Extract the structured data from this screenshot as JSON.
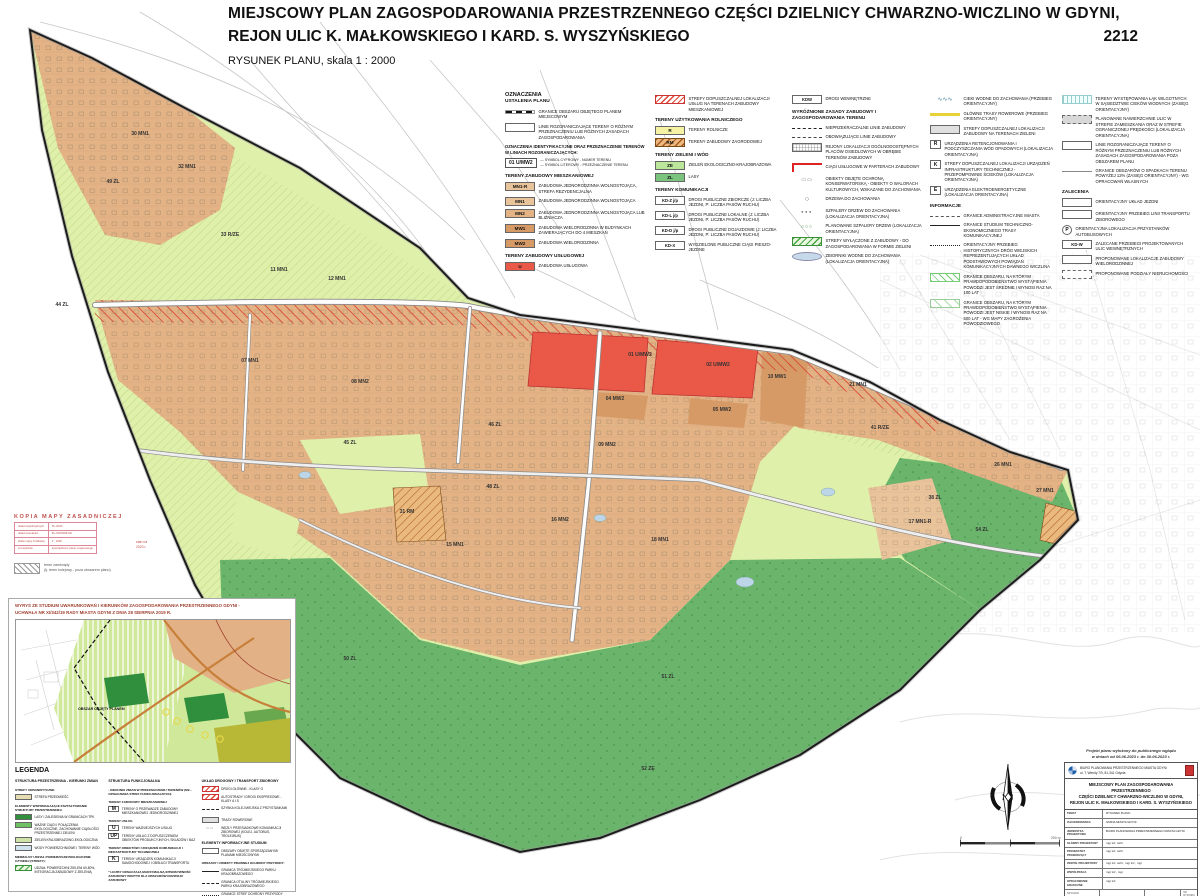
{
  "header": {
    "title_line1": "MIEJSCOWY PLAN ZAGOSPODAROWANIA PRZESTRZENNEGO CZĘŚCI DZIELNICY CHWARZNO-WICZLINO W GDYNI,",
    "title_line2": "REJON ULIC K. MAŁKOWSKIEGO I KARD. S. WYSZYŃSKIEGO",
    "plan_number": "2212",
    "subtitle": "RYSUNEK PLANU, skala 1 : 2000"
  },
  "colors": {
    "residential_tan": "#e3b285",
    "residential_dark_tan": "#d69a66",
    "services_red": "#ea5948",
    "agricultural_yellow": "#f5f2a4",
    "green_eco": "#dff0aa",
    "green_forest": "#6ab46c",
    "green_pale_band": "#bce79a",
    "stamp_red": "#c0504d",
    "boundary": "#1c1c1c"
  },
  "plan_legend": {
    "title": "OZNACZENIA",
    "subtitle": "USTALENIA PLANU",
    "columns": [
      [
        {
          "k": "title",
          "t": "OZNACZENIA"
        },
        {
          "k": "sub",
          "t": "USTALENIA PLANU"
        },
        {
          "k": "boundary",
          "t": "GRANICE OBSZARU OBJĘTEGO PLANEM MIEJSCOWYM"
        },
        {
          "k": "rozgran",
          "t": "LINIE ROZGRANICZAJĄCE TERENY O RÓŻNYM PRZEZNACZENIU LUB RÓŻNYCH ZASADACH ZAGOSPODAROWANIA"
        },
        {
          "k": "note",
          "t": "OZNACZENIA IDENTYFIKACYJNE ORAZ PRZEZNACZENIE TERENÓW W LINIACH ROZGRANICZAJĄCYCH:"
        },
        {
          "k": "example",
          "t": "01 U/MW2",
          "a": "SYMBOL CYFROWY - NUMER TERENU",
          "b": "SYMBOL LITEROWY - PRZEZNACZENIE TERENU"
        },
        {
          "k": "h",
          "t": "TERENY ZABUDOWY MIESZKANIOWEJ"
        },
        {
          "k": "sw",
          "c": "#e9c49b",
          "l": "MN1-R",
          "t": "ZABUDOWA JEDNORODZINNA WOLNOSTOJĄCA, STREFA REZYDENCJALNA"
        },
        {
          "k": "sw",
          "c": "#e9c49b",
          "l": "MN1",
          "t": "ZABUDOWA JEDNORODZINNA WOLNOSTOJĄCA"
        },
        {
          "k": "sw",
          "c": "#e3b285",
          "l": "MN2",
          "t": "ZABUDOWA JEDNORODZINNA WOLNOSTOJĄCA LUB BLIŹNIACZA"
        },
        {
          "k": "sw",
          "c": "#d69a66",
          "l": "MW1",
          "t": "ZABUDOWA WIELORODZINNA W BUDYNKACH ZAWIERAJĄCYCH DO 4 MIESZKAŃ"
        },
        {
          "k": "sw",
          "c": "#d69a66",
          "l": "MW2",
          "t": "ZABUDOWA WIELORODZINNA"
        },
        {
          "k": "h",
          "t": "TERENY ZABUDOWY USŁUGOWEJ"
        },
        {
          "k": "sw",
          "c": "#ea5948",
          "l": "U",
          "t": "ZABUDOWA USŁUGOWA"
        }
      ],
      [
        {
          "k": "hatchred",
          "t": "STREFY DOPUSZCZALNEJ LOKALIZACJI USŁUG NA TERENACH ZABUDOWY MIESZKANIOWEJ"
        },
        {
          "k": "h",
          "t": "TERENY UŻYTKOWANIA ROLNICZEGO"
        },
        {
          "k": "sw",
          "c": "#f5f2a4",
          "l": "R",
          "t": "TERENY ROLNICZE"
        },
        {
          "k": "hatchrm",
          "l": "RM",
          "t": "TERENY ZABUDOWY ZAGRODOWEJ"
        },
        {
          "k": "h",
          "t": "TERENY ZIELENI I WÓD"
        },
        {
          "k": "sw",
          "c": "#bce79a",
          "l": "ZE",
          "t": "ZIELEŃ EKOLOGICZNO-KRAJOBRAZOWA"
        },
        {
          "k": "sw",
          "c": "#7bc47e",
          "l": "ZL",
          "t": "LASY"
        },
        {
          "k": "h",
          "t": "TERENY KOMUNIKACJI"
        },
        {
          "k": "kd",
          "l": "KD-Z j/p",
          "t": "DROGI PUBLICZNE ZBIORCZE (J: LICZBA JEZDNI, P: LICZBA PASÓW RUCHU)"
        },
        {
          "k": "kd",
          "l": "KD-L j/p",
          "t": "DROGI PUBLICZNE LOKALNE (J: LICZBA JEZDNI, P: LICZBA PASÓW RUCHU)"
        },
        {
          "k": "kd",
          "l": "KD-D j/p",
          "t": "DROGI PUBLICZNE DOJAZDOWE (J: LICZBA JEZDNI, P: LICZBA PASÓW RUCHU)"
        },
        {
          "k": "kd",
          "l": "KD-X",
          "t": "WYDZIELONE PUBLICZNE CIĄGI PIESZO-JEZDNE"
        }
      ],
      [
        {
          "k": "kd",
          "l": "KDW",
          "t": "DROGI WEWNĘTRZNE"
        },
        {
          "k": "h",
          "t": "WYRÓŻNIONE ZASADY ZABUDOWY I ZAGOSPODAROWANIA TERENU"
        },
        {
          "k": "ldash",
          "t": "NIEPRZEKRACZALNE LINIE ZABUDOWY"
        },
        {
          "k": "ldashdot",
          "t": "OBOWIĄZUJĄCE LINIE ZABUDOWY"
        },
        {
          "k": "grid",
          "t": "REJONY LOKALIZACJI OGÓLNODOSTĘPNYCH PLACÓW OSIEDLOWYCH W OBRĘBIE TERENÓW ZABUDOWY"
        },
        {
          "k": "corner",
          "t": "CIĄGI USŁUGOWE W PARTERACH ZABUDOWY"
        },
        {
          "k": "monu",
          "t": "OBIEKTY OBJĘTE OCHRONĄ KONSERWATORSKĄ - OBIEKTY O WALORACH KULTUROWYCH, WSKAZANE DO ZACHOWANIA"
        },
        {
          "k": "tree",
          "t": "DRZEWA DO ZACHOWANIA"
        },
        {
          "k": "dots",
          "t": "SZPALERY DRZEW DO ZACHOWANIA (LOKALIZACJA ORIENTACYJNA)"
        },
        {
          "k": "gdots",
          "t": "PLANOWANE SZPALERY DRZEW (LOKALIZACJA ORIENTACYJNA)"
        },
        {
          "k": "ghatch",
          "t": "STREFY WYŁĄCZONE Z ZABUDOWY - DO ZAGOSPODAROWANIA W FORMIE ZIELENI"
        },
        {
          "k": "pond",
          "t": "ZBIORNIKI WODNE DO ZACHOWANIA (LOKALIZACJA ORIENTACYJNA)"
        }
      ],
      [
        {
          "k": "wave",
          "t": "CIEKI WODNE DO ZACHOWANIA (PRZEBIEG ORIENTACYJNY)"
        },
        {
          "k": "cycle",
          "t": "GŁÓWNE TRASY ROWEROWE (PRZEBIEG ORIENTACYJNY)"
        },
        {
          "k": "graybox",
          "t": "STREFY DOPUSZCZALNEJ LOKALIZACJI ZABUDOWY NA TERENACH ZIELENI"
        },
        {
          "k": "lbox",
          "l": "R",
          "t": "URZĄDZENIA RETENCJONOWANIA I PODCZYSZCZANIA WÓD OPADOWYCH (LOKALIZACJA ORIENTACYJNA)"
        },
        {
          "k": "lbox",
          "l": "K",
          "t": "STREFY DOPUSZCZALNEJ LOKALIZACJI URZĄDZEŃ INFRASTRUKTURY TECHNICZNEJ - PRZEPOMPOWNIE ŚCIEKÓW (LOKALIZACJA ORIENTACYJNA)"
        },
        {
          "k": "lbox",
          "l": "E",
          "t": "URZĄDZENIA ELEKTROENERGETYCZNE (LOKALIZACJA ORIENTACYJNA)"
        },
        {
          "k": "h",
          "t": "INFORMACJE"
        },
        {
          "k": "ladmin",
          "t": "GRANICE ADMINISTRACYJNE MIASTA"
        },
        {
          "k": "lsolid",
          "t": "GRANICE STUDIUM TECHNICZNO-EKONOMICZNEGO TRASY KOMUNIKACYJNEJ"
        },
        {
          "k": "ldot",
          "t": "ORIENTACYJNY PRZEBIEG HISTORYCZNYCH DRÓG WIEJSKICH REPREZENTUJĄCYCH UKŁAD PODSTAWOWYCH POWIĄZAŃ KOMUNIKACYJNYCH DAWNEGO WICZLINA"
        },
        {
          "k": "flood",
          "t": "GRANICE OBSZARU, NA KTÓRYM PRAWDOPODOBIEŃSTWO WYSTĄPIENIA POWODZI JEST ŚREDNIE I WYNOSI RAZ NA 100 LAT"
        },
        {
          "k": "flood2",
          "t": "GRANICE OBSZARU, NA KTÓRYM PRAWDOPODOBIEŃSTWO WYSTĄPIENIA POWODZI JEST NISKIE I WYNOSI RAZ NA 500 LAT - WG MAPY ZAGROŻENIA POWODZIOWEGO"
        }
      ],
      [
        {
          "k": "meadow",
          "t": "TERENY WYSTĘPOWANIA ŁĄK WILGOTNYCH W SĄSIEDZTWIE CIEKÓW WODNYCH (ZASIĘG ORIENTACYJNY)"
        },
        {
          "k": "graybox2",
          "t": "PLANOWANE NAWIERZCHNIE ULIC W STREFIE ZAMIESZKANIA ORAZ W STREFIE OGRANICZONEJ PRĘDKOŚCI (LOKALIZACJA ORIENTACYJNA)"
        },
        {
          "k": "rozgran",
          "t": "LINIE ROZGRANICZAJĄCE TERENY O RÓŻNYM PRZEZNACZENIU LUB RÓŻNYCH ZASADACH ZAGOSPODAROWANIA POZA OBSZAREM PLANU"
        },
        {
          "k": "lthin",
          "t": "GRANICE OBSZARÓW O SPADKACH TERENU POWYŻEJ 12% (ZASIĘG ORIENTACYJNY) - WG OPRACOWAŃ WŁASNYCH"
        },
        {
          "k": "h",
          "t": "ZALECENIA"
        },
        {
          "k": "rozgran",
          "t": "ORIENTACYJNY UKŁAD JEZDNI"
        },
        {
          "k": "rozgran",
          "t": "ORIENTACYJNY PRZEBIEG LINII TRANSPORTU ZBIOROWEGO"
        },
        {
          "k": "pcirc",
          "l": "P",
          "t": "ORIENTACYJNA LOKALIZACJA PRZYSTANKÓW AUTOBUSOWYCH"
        },
        {
          "k": "kd",
          "l": "KD-W",
          "t": "ZALECANE PRZEBIEGI PROJEKTOWANYCH ULIC WEWNĘTRZNYCH"
        },
        {
          "k": "boxw",
          "t": "PROPONOWANE LOKALIZACJE ZABUDOWY WIELORODZINNEJ"
        },
        {
          "k": "boxdash",
          "t": "PROPONOWANE PODZIAŁY NIERUCHOMOŚCI"
        }
      ]
    ]
  },
  "map": {
    "zones": [
      [
        140,
        135,
        "30 MN1"
      ],
      [
        113,
        183,
        "49 ZL"
      ],
      [
        187,
        168,
        "32 MN1"
      ],
      [
        62,
        306,
        "44 ZL"
      ],
      [
        230,
        236,
        "33 R/ZE"
      ],
      [
        279,
        271,
        "11 MN1"
      ],
      [
        337,
        280,
        "12 MN1"
      ],
      [
        250,
        362,
        "07 MN1"
      ],
      [
        360,
        383,
        "08 MN2"
      ],
      [
        640,
        356,
        "01 U/MW2"
      ],
      [
        718,
        366,
        "02 U/MW2"
      ],
      [
        615,
        400,
        "04 MW2"
      ],
      [
        722,
        411,
        "05 MW2"
      ],
      [
        607,
        446,
        "09 MN2"
      ],
      [
        777,
        378,
        "10 MW1"
      ],
      [
        495,
        426,
        "46 ZL"
      ],
      [
        493,
        488,
        "48 ZL"
      ],
      [
        350,
        444,
        "45 ZL"
      ],
      [
        407,
        513,
        "31 RM"
      ],
      [
        455,
        546,
        "15 MN1"
      ],
      [
        560,
        521,
        "16 MN2"
      ],
      [
        660,
        541,
        "18 MN1"
      ],
      [
        880,
        429,
        "41 R/ZE"
      ],
      [
        858,
        386,
        "21 MN1"
      ],
      [
        935,
        499,
        "38 ZL"
      ],
      [
        1003,
        466,
        "26 MN1"
      ],
      [
        1045,
        492,
        "27 MN1"
      ],
      [
        920,
        523,
        "17 MN1-R"
      ],
      [
        982,
        531,
        "54 ZL"
      ],
      [
        668,
        678,
        "51 ZL"
      ],
      [
        648,
        770,
        "52 ZE"
      ],
      [
        350,
        660,
        "50 ZL"
      ]
    ],
    "scalebar_left": "0",
    "scalebar_right": "200 m"
  },
  "stamp": {
    "title": "KOPIA MAPY ZASADNICZEJ",
    "rows": [
      [
        "układ współrzędnych",
        "PL-2000"
      ],
      [
        "układ wysokości",
        "PL-KRON86-NH"
      ],
      [
        "skala mapy źródłowej",
        "1 : 1000"
      ],
      [
        "cel wydania",
        "sporządzenie planu miejscowego"
      ]
    ],
    "note_line1": "stan na",
    "note_line2": "2023 r.",
    "closed_line1": "teren zamknięty",
    "closed_line2": "(tj. teren kolejowy - poza obszarem planu)"
  },
  "inset": {
    "title_line1": "WYRYS ZE STUDIUM UWARUNKOWAŃ I KIERUNKÓW ZAGOSPODAROWANIA PRZESTRZENNEGO GDYNI -",
    "title_line2": "UCHWAŁA NR XI/342/19 RADY MIASTA GDYNI Z DNIA 28 SIERPNIA 2019 R.",
    "area_label": "OBSZAR OBJĘTY PLANEM",
    "legend_title": "LEGENDA",
    "columns": [
      [
        {
          "k": "h",
          "t": "STRUKTURA PRZESTRZENNA - KIERUNKI ZMIAN"
        },
        {
          "k": "note",
          "t": "STREFY URBANISTYCZNE"
        },
        {
          "k": "sw",
          "c": "#e6dcb2",
          "t": "strefa przedmieść"
        },
        {
          "k": "note",
          "t": "ELEMENTY WSPOMAGAJĄCE KSZTAŁTOWANIE STRUKTURY PRZESTRZENNEJ:"
        },
        {
          "k": "sw",
          "c": "#2f8f3c",
          "t": "lasy i zalesienia w granicach TPK"
        },
        {
          "k": "sw",
          "c": "#6fbf63",
          "t": "ważne ciągi i połączenia ekologiczne, zachowanie ciągłości przestrzennej zieleni"
        },
        {
          "k": "sw",
          "c": "#cfe3a8",
          "t": "zieleń krajobrazowo-ekologiczna"
        },
        {
          "k": "sw",
          "c": "#cfe2ee",
          "t": "wody powierzchniowe i tereny wód"
        },
        {
          "k": "note",
          "t": "MINIMALNY UDZIAŁ POWIERZCHNI BIOLOGICZNIE CZYNNEJ (STREFY):"
        },
        {
          "k": "ghatch",
          "t": "udział powierzchni zieleni 60-80%, integracja zabudowy z zielenią"
        }
      ],
      [
        {
          "k": "h",
          "t": "STRUKTURA FUNKCJONALNA"
        },
        {
          "k": "note",
          "t": "- KIERUNKI ZMIAN W PRZEZNACZENIU TERENÓW (M2... OZNACZENIA STREF FUNKCJONALNYCH)"
        },
        {
          "k": "note",
          "t": "TERENY ZABUDOWY MIESZKANIOWEJ"
        },
        {
          "k": "lbox",
          "l": "M",
          "t": "tereny o przewadze zabudowy mieszkaniowej jednorodzinnej"
        },
        {
          "k": "note",
          "t": "TERENY USŁUG"
        },
        {
          "k": "lbox",
          "l": "U",
          "t": "tereny ważniejszych usług"
        },
        {
          "k": "lbox",
          "l": "UP",
          "t": "tereny usług z dopuszczeniem obiektów produkcyjnych, składów i baz"
        },
        {
          "k": "note",
          "t": "TERENY OBIEKTÓW I URZĄDZEŃ KOMUNIKACJI I INFRASTRUKTURY TECHNICZNEJ"
        },
        {
          "k": "lbox",
          "l": "K",
          "t": "tereny urządzeń komunikacji samochodowej i obsługi transportu"
        },
        {
          "k": "note",
          "t": "* liczby oznaczają maksymalną intensywność zabudowy brutto dla obszarów rozwoju zabudowy"
        }
      ],
      [
        {
          "k": "h",
          "t": "UKŁAD DROGOWY I TRANSPORT ZBIOROWY"
        },
        {
          "k": "hatchred",
          "t": "drogi główne - klasy G"
        },
        {
          "k": "hatchred",
          "t": "autostrady i drogi ekspresowe - klasy A i S"
        },
        {
          "k": "ldash",
          "t": "szybka kolej miejska z przystankami"
        },
        {
          "k": "graybox",
          "t": "trasy rowerowe"
        },
        {
          "k": "monu",
          "t": "węzły przesiadkowe komunikacji zbiorowej (kolej, autobus, trolejbus)"
        },
        {
          "k": "h",
          "t": "ELEMENTY INFORMACYJNE STUDIUM"
        },
        {
          "k": "boxw",
          "t": "obszary objęte sporządzanymi planami miejscowymi"
        },
        {
          "k": "note",
          "t": "OBSZARY I OBIEKTY PRAWNEJ OCHRONY PRZYRODY:"
        },
        {
          "k": "lsolid",
          "t": "granica Trójmiejskiego Parku Krajobrazowego"
        },
        {
          "k": "ldash",
          "t": "granica otuliny Trójmiejskiego Parku Krajobrazowego"
        },
        {
          "k": "ldot",
          "t": "granice stref ochrony przyrody"
        }
      ]
    ]
  },
  "titleblock": {
    "notice_line1": "Projekt planu wyłożony do publicznego wglądu",
    "notice_line2": "w dniach od 06.06.2023 r. do 30.06.2023 r.",
    "office_line1": "BIURO PLANOWANIA PRZESTRZENNEGO MIASTA GDYNI",
    "office_line2": "ul. T. Wendy 7/9, 81-341 Gdynia",
    "title_l1": "MIEJSCOWY PLAN ZAGOSPODAROWANIA PRZESTRZENNEGO",
    "title_l2": "CZĘŚCI DZIELNICY CHWARZNO-WICZLINO W GDYNI,",
    "title_l3": "REJON ULIC K. MAŁKOWSKIEGO I KARD. S. WYSZYŃSKIEGO",
    "rows": [
      {
        "label": "TEMAT",
        "value": "RYSUNEK PLANU"
      },
      {
        "label": "ZLECENIODAWCA",
        "value": "GMINA MIASTA GDYNI"
      },
      {
        "label": "JEDNOSTKA PROJEKTOWA",
        "value": "BIURO PLANOWANIA PRZESTRZENNEGO MIASTA GDYNI"
      },
      {
        "label": "GŁÓWNY PROJEKTANT",
        "value": "mgr inż. arch."
      },
      {
        "label": "PROJEKTANT PROWADZĄCY",
        "value": "mgr inż. arch."
      },
      {
        "label": "ZESPÓŁ PROJEKTOWY",
        "value": "mgr inż. arch., mgr inż., mgr"
      },
      {
        "label": "WSPÓŁPRACA",
        "value": "mgr inż., mgr"
      },
      {
        "label": "OPRACOWANIE GRAFICZNE",
        "value": "mgr inż."
      }
    ],
    "footer": {
      "plan_no_label": "NR PLANU",
      "plan_no": "2212",
      "date_label": "DATA",
      "date": "kwiecień 2023",
      "scale_label": "SKALA",
      "scale": "1 : 2000",
      "sheet_label": "NR RYSUNKU",
      "sheet": "1"
    }
  }
}
